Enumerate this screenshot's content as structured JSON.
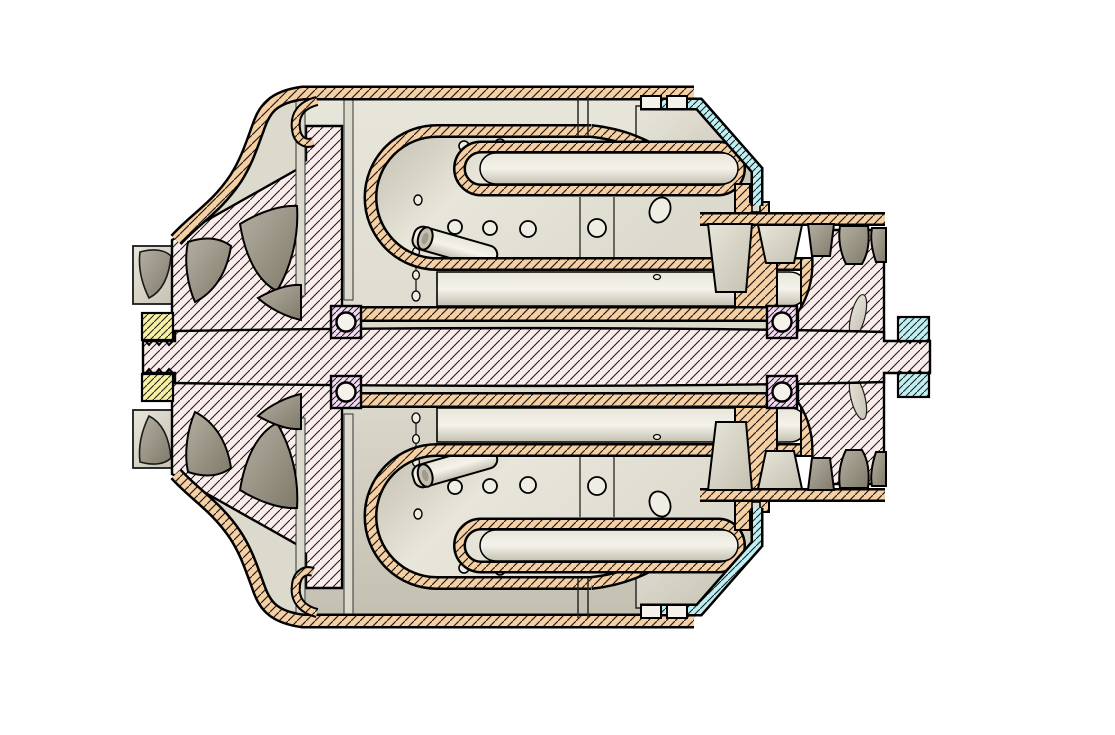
{
  "diagram": {
    "kind": "cad-cross-section",
    "subject": "gas turbine engine cutaway section view",
    "background": "#ffffff"
  },
  "colors": {
    "outline": "#000000",
    "hatch_line": "#1f1f1f",
    "peach": "#f6cfa3",
    "pink": "#fceded",
    "cyan": "#beeff2",
    "yellow": "#f6f1a3",
    "violet": "#f3daf2",
    "metal_light": "#e8e5da",
    "metal_light2": "#dcd9cd",
    "metal_mid": "#c4c0b1",
    "metal_dark": "#a09b8b",
    "blade_light": "#b4afa1",
    "blade_dark": "#7f7a6a",
    "hole_fill": "#efede4",
    "white_part": "#f4f2ea"
  },
  "parts": [
    {
      "id": "outer-casing",
      "label": "outer casing",
      "section_color": "peach"
    },
    {
      "id": "inlet-shroud",
      "label": "compressor inlet shroud",
      "section_color": "peach"
    },
    {
      "id": "compressor-impeller",
      "label": "compressor impeller hub",
      "section_color": "pink"
    },
    {
      "id": "impeller-blade",
      "label": "impeller blade",
      "section_color": "blade_dark"
    },
    {
      "id": "rotor-shaft",
      "label": "rotor shaft",
      "section_color": "pink"
    },
    {
      "id": "shaft-nut-left",
      "label": "left shaft nut",
      "section_color": "yellow"
    },
    {
      "id": "shaft-nut-right",
      "label": "right shaft nut",
      "section_color": "cyan"
    },
    {
      "id": "ball-bearing",
      "label": "ball bearing",
      "section_color": "violet"
    },
    {
      "id": "combustor-liner",
      "label": "combustion chamber liner",
      "section_color": "peach"
    },
    {
      "id": "combustor-dome",
      "label": "combustor dome",
      "section_color": "metal_light"
    },
    {
      "id": "fuel-injector",
      "label": "fuel injector tube",
      "section_color": "metal_mid"
    },
    {
      "id": "inner-duct",
      "label": "inner cooling duct",
      "section_color": "peach"
    },
    {
      "id": "bearing-sleeve",
      "label": "bearing support sleeve",
      "section_color": "peach"
    },
    {
      "id": "nozzle-vane",
      "label": "turbine nozzle guide vane",
      "section_color": "metal_mid"
    },
    {
      "id": "turbine-blade",
      "label": "turbine blade",
      "section_color": "blade_dark"
    },
    {
      "id": "turbine-disk",
      "label": "turbine disk",
      "section_color": "pink"
    },
    {
      "id": "exhaust-duct",
      "label": "exhaust duct shell",
      "section_color": "cyan"
    },
    {
      "id": "turbine-flange",
      "label": "turbine casing flange",
      "section_color": "peach"
    }
  ]
}
